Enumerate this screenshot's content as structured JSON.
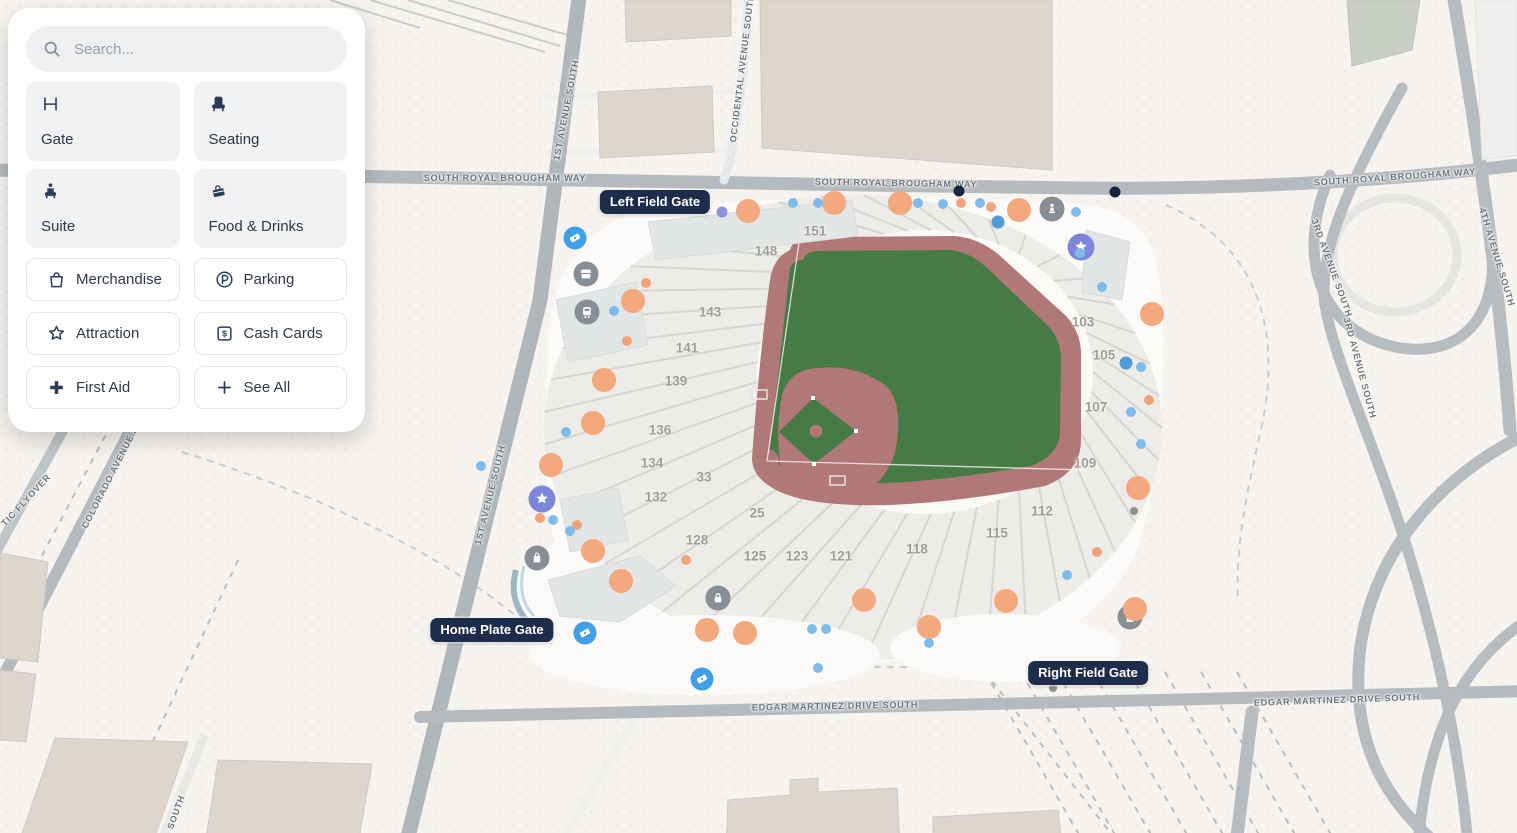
{
  "sidebar": {
    "search": {
      "placeholder": "Search...",
      "icon": "search-icon"
    },
    "primary_categories": [
      {
        "label": "Gate",
        "icon": "gate-icon"
      },
      {
        "label": "Seating",
        "icon": "seating-icon"
      },
      {
        "label": "Suite",
        "icon": "suite-icon"
      },
      {
        "label": "Food & Drinks",
        "icon": "food-drinks-icon"
      }
    ],
    "secondary_categories": [
      {
        "label": "Merchandise",
        "icon": "merchandise-icon"
      },
      {
        "label": "Parking",
        "icon": "parking-icon"
      },
      {
        "label": "Attraction",
        "icon": "attraction-icon"
      },
      {
        "label": "Cash Cards",
        "icon": "cash-cards-icon"
      },
      {
        "label": "First Aid",
        "icon": "first-aid-icon"
      },
      {
        "label": "See All",
        "icon": "see-all-icon"
      }
    ]
  },
  "map": {
    "gate_labels": [
      {
        "id": "left-field-gate",
        "label": "Left Field Gate",
        "x": 655,
        "y": 202
      },
      {
        "id": "home-plate-gate",
        "label": "Home Plate Gate",
        "x": 492,
        "y": 630
      },
      {
        "id": "right-field-gate",
        "label": "Right Field Gate",
        "x": 1088,
        "y": 673
      }
    ],
    "street_labels": [
      {
        "label": "SOUTH ROYAL BROUGHAM WAY",
        "x": 505,
        "y": 178,
        "rotate": 0
      },
      {
        "label": "SOUTH ROYAL BROUGHAM WAY",
        "x": 896,
        "y": 183,
        "rotate": 1
      },
      {
        "label": "SOUTH ROYAL BROUGHAM WAY",
        "x": 1395,
        "y": 177,
        "rotate": -4
      },
      {
        "label": "EDGAR MARTINEZ DRIVE SOUTH",
        "x": 835,
        "y": 706,
        "rotate": -1
      },
      {
        "label": "EDGAR MARTINEZ DRIVE SOUTH",
        "x": 1337,
        "y": 700,
        "rotate": -2
      },
      {
        "label": "1ST AVENUE SOUTH",
        "x": 566,
        "y": 110,
        "rotate": -79
      },
      {
        "label": "1ST AVENUE SOUTH",
        "x": 490,
        "y": 495,
        "rotate": -76
      },
      {
        "label": "SOUTH",
        "x": 176,
        "y": 812,
        "rotate": -70
      },
      {
        "label": "OCCIDENTAL AVENUE SOUTH",
        "x": 742,
        "y": 68,
        "rotate": -83
      },
      {
        "label": "COLORADO AVENUE S",
        "x": 110,
        "y": 477,
        "rotate": -63
      },
      {
        "label": "TIC FLYOVER",
        "x": 26,
        "y": 500,
        "rotate": -47
      },
      {
        "label": "3RD AVENUE SOUTH",
        "x": 1332,
        "y": 268,
        "rotate": 70
      },
      {
        "label": "3RD AVENUE SOUTH",
        "x": 1360,
        "y": 368,
        "rotate": 75
      },
      {
        "label": "4TH AVENUE SOUTH",
        "x": 1497,
        "y": 257,
        "rotate": 73
      }
    ],
    "sections": [
      {
        "number": "151",
        "x": 815,
        "y": 231
      },
      {
        "number": "148",
        "x": 766,
        "y": 251
      },
      {
        "number": "143",
        "x": 710,
        "y": 312
      },
      {
        "number": "141",
        "x": 687,
        "y": 348
      },
      {
        "number": "139",
        "x": 676,
        "y": 381
      },
      {
        "number": "136",
        "x": 660,
        "y": 430
      },
      {
        "number": "134",
        "x": 652,
        "y": 463
      },
      {
        "number": "132",
        "x": 656,
        "y": 497
      },
      {
        "number": "128",
        "x": 697,
        "y": 540
      },
      {
        "number": "125",
        "x": 755,
        "y": 556
      },
      {
        "number": "123",
        "x": 797,
        "y": 556
      },
      {
        "number": "121",
        "x": 841,
        "y": 556
      },
      {
        "number": "118",
        "x": 917,
        "y": 549
      },
      {
        "number": "115",
        "x": 997,
        "y": 533
      },
      {
        "number": "112",
        "x": 1042,
        "y": 511
      },
      {
        "number": "109",
        "x": 1085,
        "y": 463
      },
      {
        "number": "107",
        "x": 1096,
        "y": 407
      },
      {
        "number": "105",
        "x": 1104,
        "y": 355
      },
      {
        "number": "103",
        "x": 1083,
        "y": 322
      },
      {
        "number": "33",
        "x": 704,
        "y": 477
      },
      {
        "number": "25",
        "x": 757,
        "y": 513
      }
    ],
    "markers": [
      {
        "type": "ticket",
        "x": 575,
        "y": 238
      },
      {
        "type": "ticket",
        "x": 585,
        "y": 633
      },
      {
        "type": "ticket",
        "x": 702,
        "y": 679
      },
      {
        "type": "star",
        "x": 1081,
        "y": 247
      },
      {
        "type": "star",
        "x": 542,
        "y": 499
      },
      {
        "type": "navy-dot",
        "x": 959,
        "y": 191
      },
      {
        "type": "navy-dot",
        "x": 1115,
        "y": 192
      },
      {
        "type": "shop",
        "x": 586,
        "y": 274
      },
      {
        "type": "train",
        "x": 587,
        "y": 312
      },
      {
        "type": "bag",
        "x": 537,
        "y": 558
      },
      {
        "type": "statue",
        "x": 1052,
        "y": 209
      },
      {
        "type": "lock",
        "x": 718,
        "y": 598
      },
      {
        "type": "building",
        "x": 1130,
        "y": 617
      },
      {
        "type": "gray-dot",
        "x": 1134,
        "y": 511
      },
      {
        "type": "gray-dot",
        "x": 1053,
        "y": 688
      },
      {
        "type": "lavender",
        "x": 722,
        "y": 212
      },
      {
        "type": "orange-large",
        "x": 748,
        "y": 211
      },
      {
        "type": "orange-large",
        "x": 834,
        "y": 203
      },
      {
        "type": "orange-large",
        "x": 900,
        "y": 203
      },
      {
        "type": "orange-large",
        "x": 1019,
        "y": 210
      },
      {
        "type": "orange-large",
        "x": 1152,
        "y": 314
      },
      {
        "type": "orange-large",
        "x": 1138,
        "y": 488
      },
      {
        "type": "orange-large",
        "x": 1135,
        "y": 609
      },
      {
        "type": "orange-large",
        "x": 1006,
        "y": 601
      },
      {
        "type": "orange-large",
        "x": 929,
        "y": 627
      },
      {
        "type": "orange-large",
        "x": 864,
        "y": 600
      },
      {
        "type": "orange-large",
        "x": 745,
        "y": 633
      },
      {
        "type": "orange-large",
        "x": 707,
        "y": 630
      },
      {
        "type": "orange-large",
        "x": 633,
        "y": 301
      },
      {
        "type": "orange-large",
        "x": 604,
        "y": 380
      },
      {
        "type": "orange-large",
        "x": 593,
        "y": 423
      },
      {
        "type": "orange-large",
        "x": 551,
        "y": 465
      },
      {
        "type": "orange-large",
        "x": 593,
        "y": 551
      },
      {
        "type": "orange-large",
        "x": 621,
        "y": 581
      },
      {
        "type": "orange-small",
        "x": 646,
        "y": 283
      },
      {
        "type": "orange-small",
        "x": 627,
        "y": 341
      },
      {
        "type": "orange-small",
        "x": 540,
        "y": 518
      },
      {
        "type": "orange-small",
        "x": 577,
        "y": 525
      },
      {
        "type": "orange-small",
        "x": 686,
        "y": 560
      },
      {
        "type": "orange-small",
        "x": 961,
        "y": 203
      },
      {
        "type": "orange-small",
        "x": 991,
        "y": 207
      },
      {
        "type": "orange-small",
        "x": 1149,
        "y": 400
      },
      {
        "type": "orange-small",
        "x": 1097,
        "y": 552
      },
      {
        "type": "blue-small",
        "x": 793,
        "y": 203
      },
      {
        "type": "blue-small",
        "x": 818,
        "y": 203
      },
      {
        "type": "blue-small",
        "x": 918,
        "y": 203
      },
      {
        "type": "blue-small",
        "x": 943,
        "y": 204
      },
      {
        "type": "blue-small",
        "x": 980,
        "y": 203
      },
      {
        "type": "blue-small",
        "x": 1076,
        "y": 212
      },
      {
        "type": "blue-small",
        "x": 1080,
        "y": 253
      },
      {
        "type": "blue-small",
        "x": 1102,
        "y": 287
      },
      {
        "type": "blue-small",
        "x": 1141,
        "y": 367
      },
      {
        "type": "blue-small",
        "x": 1131,
        "y": 412
      },
      {
        "type": "blue-small",
        "x": 1141,
        "y": 444
      },
      {
        "type": "blue-small",
        "x": 812,
        "y": 629
      },
      {
        "type": "blue-small",
        "x": 826,
        "y": 629
      },
      {
        "type": "blue-small",
        "x": 1067,
        "y": 575
      },
      {
        "type": "blue-small",
        "x": 614,
        "y": 311
      },
      {
        "type": "blue-small",
        "x": 566,
        "y": 432
      },
      {
        "type": "blue-small",
        "x": 553,
        "y": 520
      },
      {
        "type": "blue-small",
        "x": 570,
        "y": 531
      },
      {
        "type": "blue-small",
        "x": 481,
        "y": 466
      },
      {
        "type": "blue-small",
        "x": 818,
        "y": 668
      },
      {
        "type": "blue-small",
        "x": 929,
        "y": 643
      },
      {
        "type": "blue-medium",
        "x": 998,
        "y": 222
      },
      {
        "type": "blue-medium",
        "x": 1126,
        "y": 363
      }
    ]
  },
  "colors": {
    "field_green": "#477b45",
    "field_dirt": "#b17878",
    "gate_label_bg": "#1e2c4c",
    "marker_orange": "#f4a87e",
    "marker_blue": "#3fa0e8",
    "marker_purple": "#7d87da",
    "icon_navy": "#2b3b5c"
  }
}
